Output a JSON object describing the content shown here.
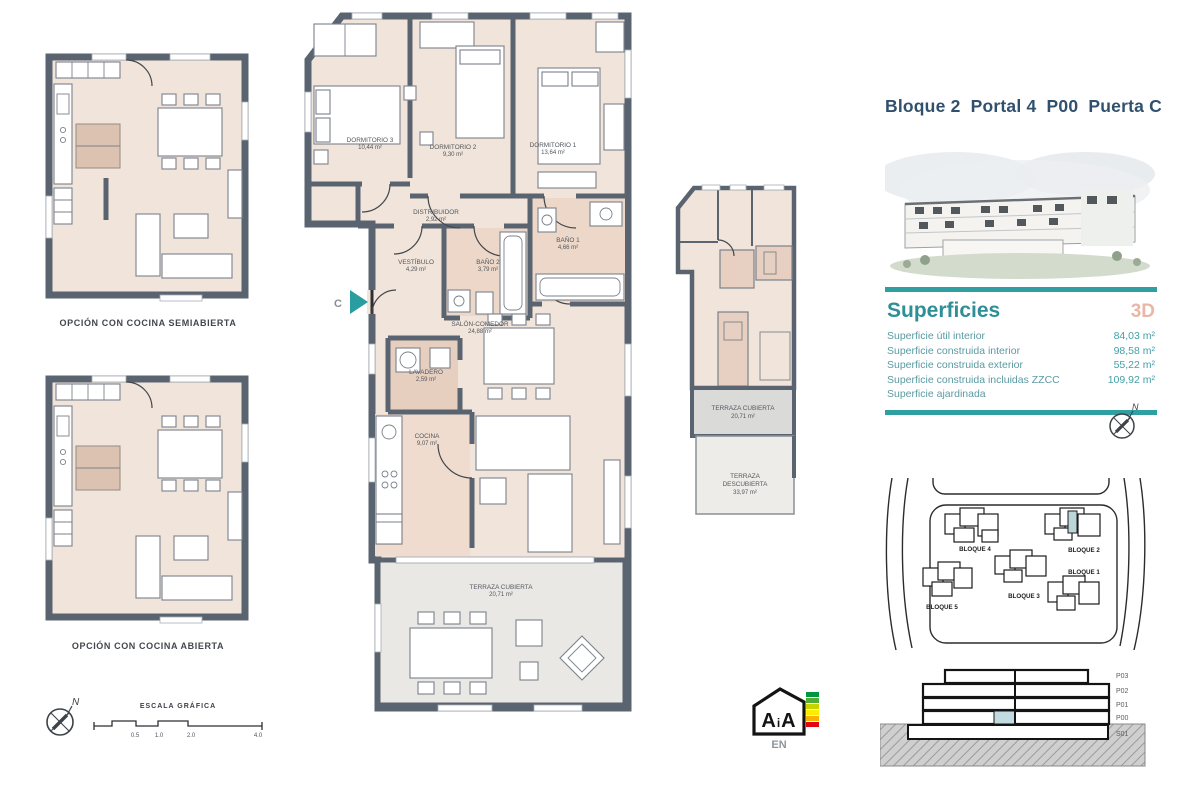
{
  "accent_colors": {
    "teal": "#2f9fa1",
    "navy_title": "#31506e",
    "salmon_3d": "#e8b7a6",
    "wall_gray": "#5a6470",
    "floor_beige": "#f1e4da",
    "terrace_gray": "#e9e8e4",
    "highlight_unit": "#bcd6d8"
  },
  "header": {
    "title": "Bloque 2  Portal 4  P00  Puerta C"
  },
  "superficies": {
    "heading": "Superficies",
    "badge_3d": "3D",
    "rows": [
      {
        "label": "Superficie útil interior",
        "value": "84,03 m²"
      },
      {
        "label": "Superficie construida interior",
        "value": "98,58 m²"
      },
      {
        "label": "Superficie construida exterior",
        "value": "55,22 m²"
      },
      {
        "label": "Superficie construida incluidas ZZCC",
        "value": "109,92 m²"
      },
      {
        "label": "Superficie ajardinada",
        "value": ""
      }
    ]
  },
  "options": {
    "semi": "OPCIÓN CON COCINA SEMIABIERTA",
    "open": "OPCIÓN CON COCINA ABIERTA"
  },
  "main_plan": {
    "entrance_label": "C",
    "rooms": [
      {
        "name": "DORMITORIO 3",
        "area": "10,44 m²"
      },
      {
        "name": "DORMITORIO 2",
        "area": "9,30 m²"
      },
      {
        "name": "DORMITORIO 1",
        "area": "13,64 m²"
      },
      {
        "name": "DISTRIBUIDOR",
        "area": "2,92 m²"
      },
      {
        "name": "VESTÍBULO",
        "area": "4,29 m²"
      },
      {
        "name": "BAÑO 2",
        "area": "3,79 m²"
      },
      {
        "name": "BAÑO 1",
        "area": "4,66 m²"
      },
      {
        "name": "SALÓN-COMEDOR",
        "area": "24,88 m²"
      },
      {
        "name": "LAVADERO",
        "area": "2,59 m²"
      },
      {
        "name": "COCINA",
        "area": "9,07 m²"
      },
      {
        "name": "TERRAZA CUBIERTA",
        "area": "20,71 m²"
      }
    ]
  },
  "overview_plan": {
    "terraza_cubierta": {
      "name": "TERRAZA CUBIERTA",
      "area": "20,71 m²"
    },
    "terraza_descubierta": {
      "name_line1": "TERRAZA",
      "name_line2": "DESCUBIERTA",
      "area": "33,97 m²"
    }
  },
  "site_plan": {
    "blocks": [
      "BLOQUE 4",
      "BLOQUE 2",
      "BLOQUE 5",
      "BLOQUE 3",
      "BLOQUE 1"
    ]
  },
  "elevation": {
    "levels": [
      "P03",
      "P02",
      "P01",
      "P00",
      "S01"
    ]
  },
  "scale_bar": {
    "title": "ESCALA GRÁFICA",
    "ticks": [
      "0.5",
      "1.0",
      "2.0",
      "4.0"
    ]
  },
  "energy": {
    "label": "EN"
  },
  "compass": {
    "north": "N"
  }
}
